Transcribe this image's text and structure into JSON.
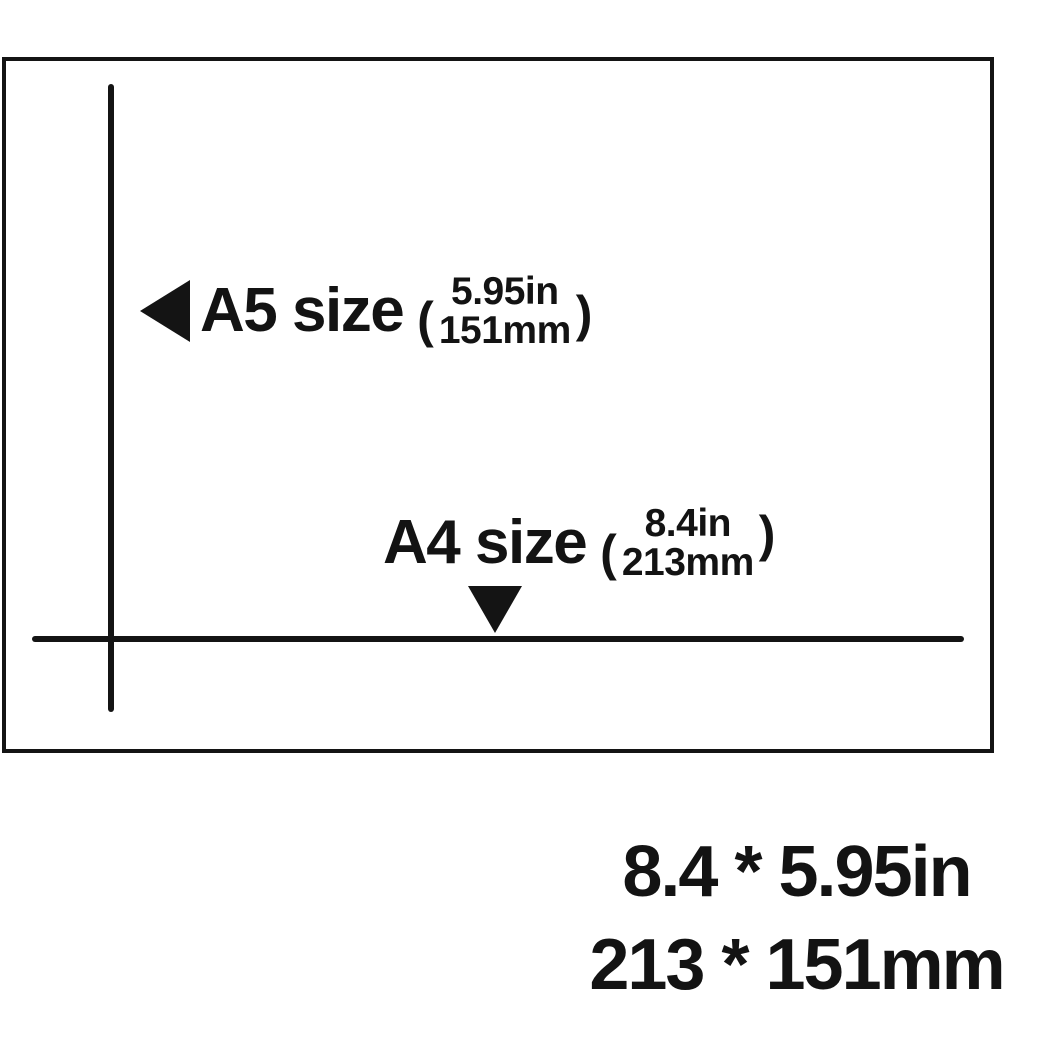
{
  "colors": {
    "ink": "#141414",
    "background": "#ffffff"
  },
  "diagram": {
    "a5": {
      "arrow_icon": "triangle-left",
      "label": "A5 size",
      "paren_open": "(",
      "inches": "5.95in",
      "mm": "151mm",
      "paren_close": ")"
    },
    "a4": {
      "arrow_icon": "triangle-down",
      "label": "A4 size",
      "paren_open": "(",
      "inches": "8.4in",
      "mm": "213mm",
      "paren_close": ")"
    }
  },
  "footer": {
    "line1": "8.4 * 5.95in",
    "line2": "213 * 151mm"
  }
}
